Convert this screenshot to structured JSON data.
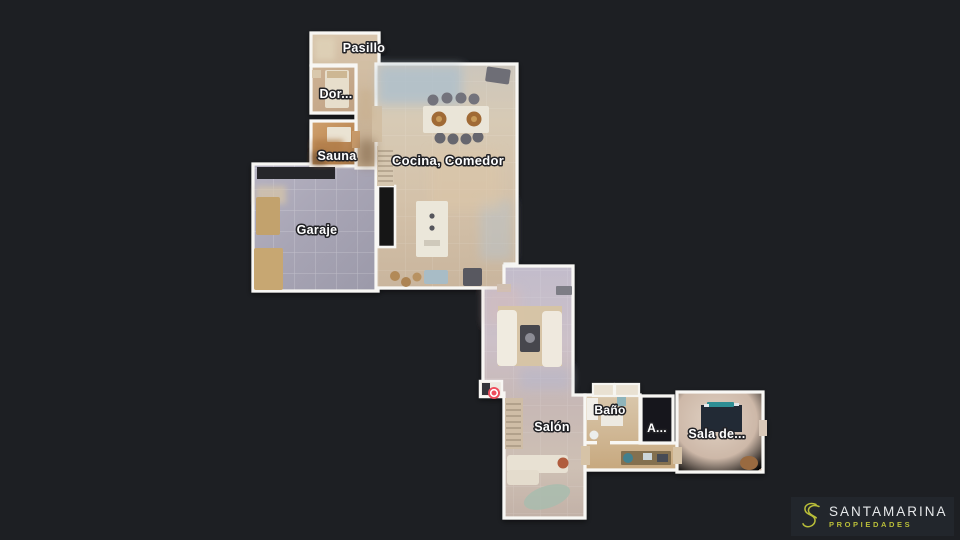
{
  "background": {
    "color": "#1d1f23"
  },
  "floorplan": {
    "wall_color": "#f8f7f4",
    "label_text_color": "#ffffff",
    "rooms": {
      "pasillo": {
        "label": "Pasillo"
      },
      "dormitorio": {
        "label": "Dor..."
      },
      "sauna": {
        "label": "Sauna"
      },
      "cocina_comedor": {
        "label": "Cocina, Comedor"
      },
      "garaje": {
        "label": "Garaje"
      },
      "salon": {
        "label": "Salón"
      },
      "bano": {
        "label": "Baño"
      },
      "room_a": {
        "label": "A..."
      },
      "sala_de": {
        "label": "Sala de..."
      }
    },
    "position_marker": {
      "color": "#ee4d5c"
    }
  },
  "branding": {
    "name": "SANTAMARINA",
    "tagline": "PROPIEDADES",
    "accent_color": "#b9be39",
    "name_color": "#e6e8ea"
  }
}
